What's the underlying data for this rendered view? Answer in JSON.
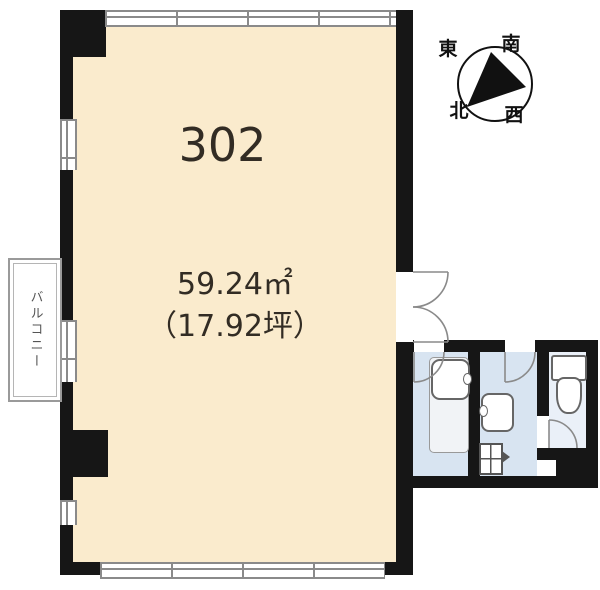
{
  "page": {
    "background": "#ffffff"
  },
  "room": {
    "number": "302",
    "area_m2": "59.24㎡",
    "area_tsubo": "（17.92坪）"
  },
  "balcony": {
    "label": "バルコニー"
  },
  "compass": {
    "east": "東",
    "south": "南",
    "north": "北",
    "west": "西"
  },
  "colors": {
    "wall": "#161616",
    "room_fill": "#FAEBCD",
    "wet_area_floor": "#D8E4F1",
    "toilet_floor": "#EAF0F8",
    "fixture_outline": "#666666",
    "window_line": "#8a8a8a",
    "text": "#322c24"
  },
  "fixtures": {
    "washroom_sink": "washbasin",
    "washroom_counter": "vanity counter",
    "middle_sink": "washbasin",
    "middle_unit": "small sink unit",
    "toilet": "toilet"
  }
}
